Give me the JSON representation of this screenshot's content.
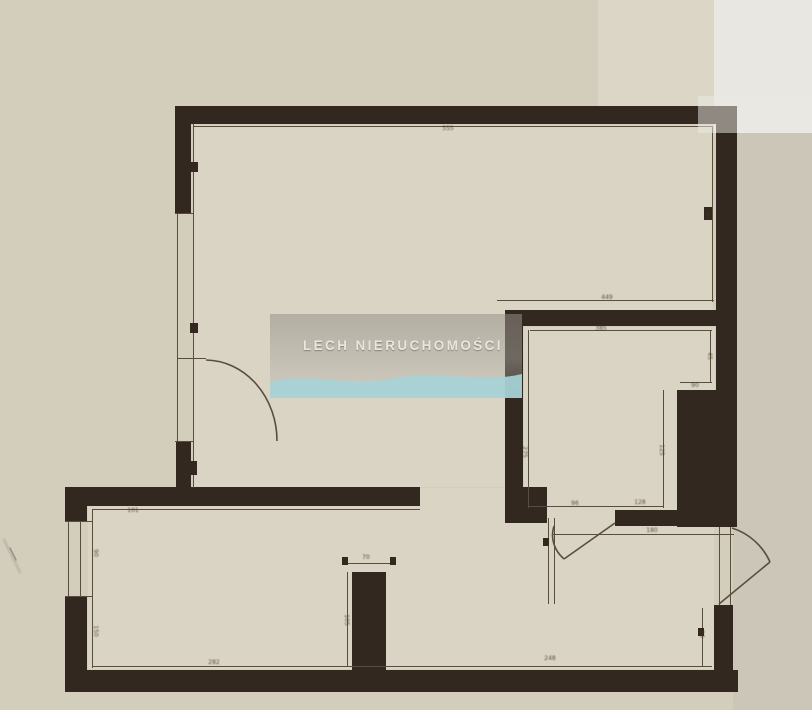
{
  "watermark": {
    "text": "LECH NIERUCHOMOŚCI",
    "panel": {
      "x": 270,
      "y": 314,
      "w": 252,
      "h": 84
    },
    "wave_color": "#a7d2d6"
  },
  "colors": {
    "paper": "#d3cdbc",
    "paper_light": "#dbd6c6",
    "white_strip": "#e9e7e1",
    "gray_strip": "#ccc6b9",
    "room": "#d9d4c3",
    "wall": "#32281f",
    "line": "#5a4d3e",
    "label": "#46382a",
    "scratch": "#c2bcae"
  },
  "plan": {
    "bg_strips": [
      {
        "x": 598,
        "y": 0,
        "w": 214,
        "h": 112,
        "color": "#dbd6c6"
      },
      {
        "x": 714,
        "y": 0,
        "w": 98,
        "h": 133,
        "color": "#e9e7e1"
      },
      {
        "x": 733,
        "y": 133,
        "w": 79,
        "h": 577,
        "color": "#ccc6b9"
      }
    ],
    "room_fills": [
      {
        "x": 194,
        "y": 125,
        "w": 519,
        "h": 185
      },
      {
        "x": 194,
        "y": 300,
        "w": 311,
        "h": 187
      },
      {
        "x": 524,
        "y": 327,
        "w": 191,
        "h": 182
      },
      {
        "x": 88,
        "y": 506,
        "w": 626,
        "h": 163
      },
      {
        "x": 420,
        "y": 488,
        "w": 85,
        "h": 19
      }
    ],
    "walls": [
      {
        "x": 175,
        "y": 106,
        "w": 562,
        "h": 18
      },
      {
        "x": 716,
        "y": 124,
        "w": 21,
        "h": 403
      },
      {
        "x": 175,
        "y": 124,
        "w": 16,
        "h": 90
      },
      {
        "x": 176,
        "y": 442,
        "w": 15,
        "h": 62
      },
      {
        "x": 65,
        "y": 487,
        "w": 355,
        "h": 19
      },
      {
        "x": 65,
        "y": 506,
        "w": 22,
        "h": 16
      },
      {
        "x": 65,
        "y": 597,
        "w": 22,
        "h": 95
      },
      {
        "x": 65,
        "y": 670,
        "w": 673,
        "h": 22
      },
      {
        "x": 352,
        "y": 572,
        "w": 34,
        "h": 100
      },
      {
        "x": 505,
        "y": 310,
        "w": 211,
        "h": 16
      },
      {
        "x": 505,
        "y": 326,
        "w": 18,
        "h": 161
      },
      {
        "x": 505,
        "y": 487,
        "w": 42,
        "h": 36
      },
      {
        "x": 615,
        "y": 510,
        "w": 62,
        "h": 16
      },
      {
        "x": 677,
        "y": 390,
        "w": 39,
        "h": 137
      },
      {
        "x": 714,
        "y": 605,
        "w": 19,
        "h": 87
      }
    ],
    "thin_lines": [
      {
        "x": 177,
        "y": 214,
        "w": 1.4,
        "h": 228
      },
      {
        "x": 193,
        "y": 124,
        "w": 1.4,
        "h": 364
      },
      {
        "x": 193,
        "y": 126,
        "w": 519,
        "h": 1.4
      },
      {
        "x": 712,
        "y": 126,
        "w": 1.4,
        "h": 176
      },
      {
        "x": 497,
        "y": 300,
        "w": 217,
        "h": 1.4
      },
      {
        "x": 530,
        "y": 330,
        "w": 182,
        "h": 1.4
      },
      {
        "x": 528,
        "y": 330,
        "w": 1.4,
        "h": 178
      },
      {
        "x": 710,
        "y": 330,
        "w": 1.4,
        "h": 52
      },
      {
        "x": 680,
        "y": 382,
        "w": 32,
        "h": 1.4
      },
      {
        "x": 663,
        "y": 390,
        "w": 1.4,
        "h": 118
      },
      {
        "x": 528,
        "y": 506,
        "w": 135,
        "h": 1.4
      },
      {
        "x": 553,
        "y": 534,
        "w": 181,
        "h": 1.4
      },
      {
        "x": 548,
        "y": 518,
        "w": 1.4,
        "h": 86
      },
      {
        "x": 554,
        "y": 518,
        "w": 1.4,
        "h": 86
      },
      {
        "x": 719,
        "y": 527,
        "w": 1.4,
        "h": 78
      },
      {
        "x": 730,
        "y": 527,
        "w": 1.4,
        "h": 78
      },
      {
        "x": 92,
        "y": 509,
        "w": 328,
        "h": 1.4
      },
      {
        "x": 92,
        "y": 509,
        "w": 1.4,
        "h": 159
      },
      {
        "x": 92,
        "y": 666,
        "w": 620,
        "h": 1.4
      },
      {
        "x": 68,
        "y": 522,
        "w": 1.4,
        "h": 75
      },
      {
        "x": 80,
        "y": 522,
        "w": 1.4,
        "h": 75
      },
      {
        "x": 344,
        "y": 563,
        "w": 50,
        "h": 1.4
      },
      {
        "x": 347,
        "y": 572,
        "w": 1.4,
        "h": 94
      },
      {
        "x": 177,
        "y": 358,
        "w": 29,
        "h": 1.4
      },
      {
        "x": 175,
        "y": 213,
        "w": 18,
        "h": 1.4
      },
      {
        "x": 175,
        "y": 441,
        "w": 18,
        "h": 1.4
      },
      {
        "x": 65,
        "y": 596,
        "w": 27,
        "h": 1.4
      },
      {
        "x": 65,
        "y": 521,
        "w": 27,
        "h": 1.4
      },
      {
        "x": 702,
        "y": 608,
        "w": 1.4,
        "h": 58
      }
    ],
    "ticks": [
      {
        "x": 190,
        "y": 162,
        "w": 8,
        "h": 10
      },
      {
        "x": 190,
        "y": 323,
        "w": 8,
        "h": 10
      },
      {
        "x": 188,
        "y": 461,
        "w": 9,
        "h": 14
      },
      {
        "x": 704,
        "y": 207,
        "w": 8,
        "h": 13
      },
      {
        "x": 342,
        "y": 557,
        "w": 6,
        "h": 8
      },
      {
        "x": 390,
        "y": 557,
        "w": 6,
        "h": 8
      },
      {
        "x": 698,
        "y": 628,
        "w": 6,
        "h": 8
      },
      {
        "x": 543,
        "y": 538,
        "w": 6,
        "h": 8
      }
    ],
    "dim_labels": [
      {
        "text": "555",
        "x": 448,
        "y": 129,
        "rot": 0
      },
      {
        "text": "290",
        "x": 707,
        "y": 214,
        "rot": 90
      },
      {
        "text": "449",
        "x": 607,
        "y": 298,
        "rot": 0
      },
      {
        "text": "385",
        "x": 601,
        "y": 329,
        "rot": 0
      },
      {
        "text": "45",
        "x": 709,
        "y": 356,
        "rot": 90
      },
      {
        "text": "90",
        "x": 695,
        "y": 386,
        "rot": 0
      },
      {
        "text": "125",
        "x": 661,
        "y": 450,
        "rot": 90
      },
      {
        "text": "275",
        "x": 524,
        "y": 452,
        "rot": 90
      },
      {
        "text": "101",
        "x": 133,
        "y": 511,
        "rot": 0
      },
      {
        "text": "90",
        "x": 95,
        "y": 553,
        "rot": 90
      },
      {
        "text": "150",
        "x": 95,
        "y": 631,
        "rot": 90
      },
      {
        "text": "282",
        "x": 214,
        "y": 663,
        "rot": 0
      },
      {
        "text": "70",
        "x": 366,
        "y": 558,
        "rot": 0
      },
      {
        "text": "105",
        "x": 346,
        "y": 620,
        "rot": 90
      },
      {
        "text": "180",
        "x": 652,
        "y": 531,
        "rot": 0
      },
      {
        "text": "96",
        "x": 575,
        "y": 504,
        "rot": 0
      },
      {
        "text": "128",
        "x": 640,
        "y": 503,
        "rot": 0
      },
      {
        "text": "248",
        "x": 550,
        "y": 659,
        "rot": 0
      },
      {
        "text": "90",
        "x": 701,
        "y": 634,
        "rot": 90
      }
    ],
    "door_paths": [
      {
        "d": "M206,360 A72,81 0 0 1 277,441"
      },
      {
        "d": "M615,523 L564,559"
      },
      {
        "d": "M554,526 A40,34 0 0 0 564,559"
      },
      {
        "d": "M719,604 L770,562"
      },
      {
        "d": "M732,528 A62,62 0 0 1 770,562"
      }
    ],
    "scratch_paths": [
      {
        "d": "M4,540 L20,572",
        "w": 3,
        "color": "#c2bcae"
      },
      {
        "d": "M10,548 L16,560",
        "w": 1.5,
        "color": "#9a9284"
      }
    ],
    "overlays": [
      {
        "x": 698,
        "y": 96,
        "w": 114,
        "h": 37,
        "color": "rgba(236,234,229,0.5)"
      }
    ]
  }
}
